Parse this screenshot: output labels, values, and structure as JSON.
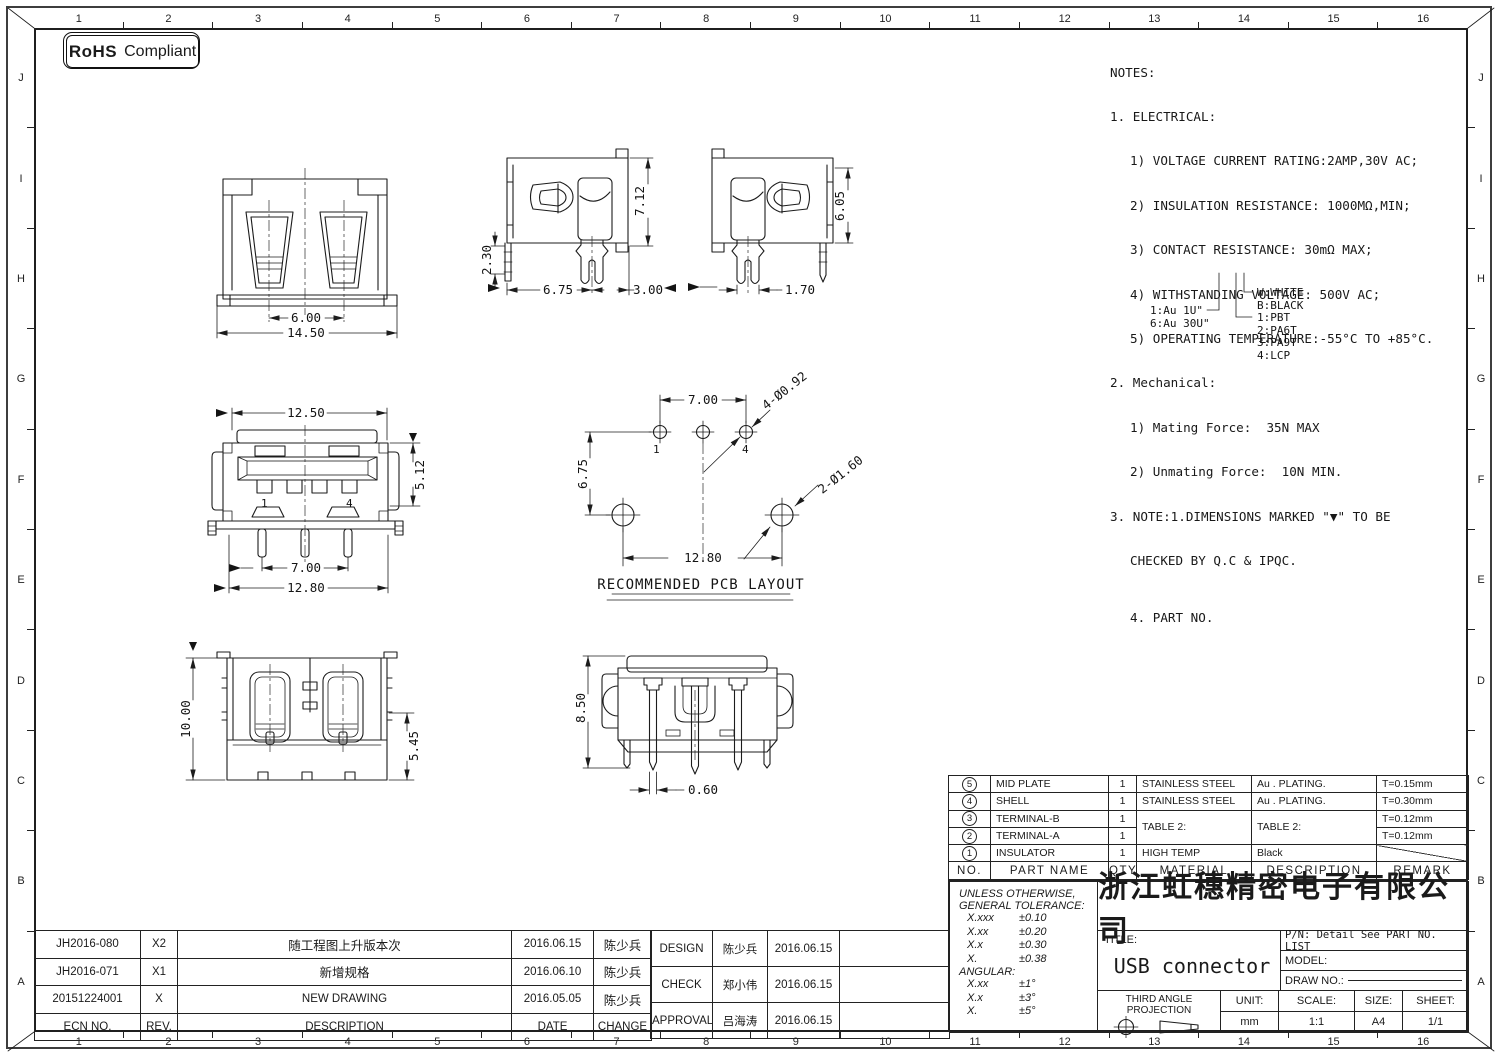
{
  "rohs": {
    "bold": "RoHS",
    "rest": "Compliant"
  },
  "border": {
    "cols": [
      "1",
      "2",
      "3",
      "4",
      "5",
      "6",
      "7",
      "8",
      "9",
      "10",
      "11",
      "12",
      "13",
      "14",
      "15",
      "16"
    ],
    "rows": [
      "J",
      "I",
      "H",
      "G",
      "F",
      "E",
      "D",
      "C",
      "B",
      "A"
    ]
  },
  "notes": {
    "l0": "NOTES:",
    "l1": "1. ELECTRICAL:",
    "l2": "1) VOLTAGE CURRENT RATING:2AMP,30V AC;",
    "l3": "2) INSULATION RESISTANCE: 1000MΩ,MIN;",
    "l4": "3) CONTACT RESISTANCE: 30mΩ MAX;",
    "l5": "4) WITHSTANDING VOLTAGE: 500V AC;",
    "l6": "5) OPERATING TEMPERATURE:-55°C TO +85°C.",
    "l7": "2. Mechanical:",
    "l8": "1) Mating Force:  35N MAX",
    "l9": "2) Unmating Force:  10N MIN.",
    "l10": "3. NOTE:1.DIMENSIONS MARKED \"▼\" TO BE",
    "l11": "CHECKED BY Q.C & IPQC.",
    "l12": "4. PART NO."
  },
  "part_tree": {
    "au1": "1:Au 1U\"",
    "au6": "6:Au 30U\"",
    "w": "W:WHITE",
    "b": "B:BLACK",
    "p1": "1:PBT",
    "p2": "2:PA6T",
    "p3": "3:PA9T",
    "p4": "4:LCP"
  },
  "views": {
    "back": {
      "d1": "6.00",
      "d2": "14.50"
    },
    "side1": {
      "d1": "2.30",
      "d2": "7.12",
      "d3": "6.75",
      "d4": "3.00"
    },
    "side2": {
      "d1": "6.05",
      "d2": "1.70"
    },
    "front": {
      "d1": "12.50",
      "d2": "5.12",
      "d3": "7.00",
      "d4": "12.80",
      "p1": "1",
      "p4": "4"
    },
    "pcb": {
      "d1": "7.00",
      "d2": "6.75",
      "d3": "12.80",
      "h1": "4-Ø0.92",
      "h2": "2-Ø1.60",
      "p1": "1",
      "p4": "4",
      "caption": "RECOMMENDED PCB LAYOUT"
    },
    "top": {
      "d1": "10.00",
      "d2": "5.45"
    },
    "rear": {
      "d1": "8.50",
      "d2": "0.60"
    }
  },
  "bom": {
    "headers": [
      "NO.",
      "PART NAME",
      "QTY",
      "MATERIAL",
      "DESCRIPTION",
      "REMARK"
    ],
    "rows": [
      {
        "no": "5",
        "part": "MID PLATE",
        "qty": "1",
        "material": "STAINLESS STEEL",
        "desc": "Au . PLATING.",
        "remark": "T=0.15mm"
      },
      {
        "no": "4",
        "part": "SHELL",
        "qty": "1",
        "material": "STAINLESS STEEL",
        "desc": "Au . PLATING.",
        "remark": "T=0.30mm"
      },
      {
        "no": "3",
        "part": "TERMINAL-B",
        "qty": "1",
        "material": "TABLE 2:",
        "desc": "TABLE 2:",
        "remark": "T=0.12mm"
      },
      {
        "no": "2",
        "part": "TERMINAL-A",
        "qty": "1",
        "remark": "T=0.12mm"
      },
      {
        "no": "1",
        "part": "INSULATOR",
        "qty": "1",
        "material": "HIGH TEMP",
        "desc": "Black",
        "remark": ""
      }
    ]
  },
  "title_block": {
    "company": "浙江虹穗精密电子有限公司",
    "tol_l1": "UNLESS OTHERWISE,",
    "tol_l2": "GENERAL TOLERANCE:",
    "tol0l": "X.xxx",
    "tol0v": "±0.10",
    "tol1l": "X.xx",
    "tol1v": "±0.20",
    "tol2l": "X.x",
    "tol2v": "±0.30",
    "tol3l": "X.",
    "tol3v": "±0.38",
    "angular_label": "ANGULAR:",
    "ang0l": "X.xx",
    "ang0v": "±1°",
    "ang1l": "X.x",
    "ang1v": "±3°",
    "ang2l": "X.",
    "ang2v": "±5°",
    "title_label": "TITLE:",
    "title_value": "USB connector",
    "pn": "P/N: Detail See PART NO. LIST",
    "model_label": "MODEL:",
    "draw_no_label": "DRAW NO.:",
    "projection": "THIRD ANGLE PROJECTION",
    "unit_label": "UNIT:",
    "unit_value": "mm",
    "scale_label": "SCALE:",
    "scale_value": "1:1",
    "size_label": "SIZE:",
    "size_value": "A4",
    "sheet_label": "SHEET:",
    "sheet_value": "1/1"
  },
  "revisions": {
    "headers": [
      "ECN NO.",
      "REV.",
      "DESCRIPTION",
      "DATE",
      "CHANGE"
    ],
    "rows": [
      [
        "JH2016-080",
        "X2",
        "随工程图上升版本次",
        "2016.06.15",
        "陈少兵"
      ],
      [
        "JH2016-071",
        "X1",
        "新增规格",
        "2016.06.10",
        "陈少兵"
      ],
      [
        "20151224001",
        "X",
        "NEW DRAWING",
        "2016.05.05",
        "陈少兵"
      ]
    ]
  },
  "approvals": {
    "rows": [
      [
        "DESIGN",
        "陈少兵",
        "2016.06.15"
      ],
      [
        "CHECK",
        "郑小伟",
        "2016.06.15"
      ],
      [
        "APPROVAL",
        "吕海涛",
        "2016.06.15"
      ]
    ]
  }
}
